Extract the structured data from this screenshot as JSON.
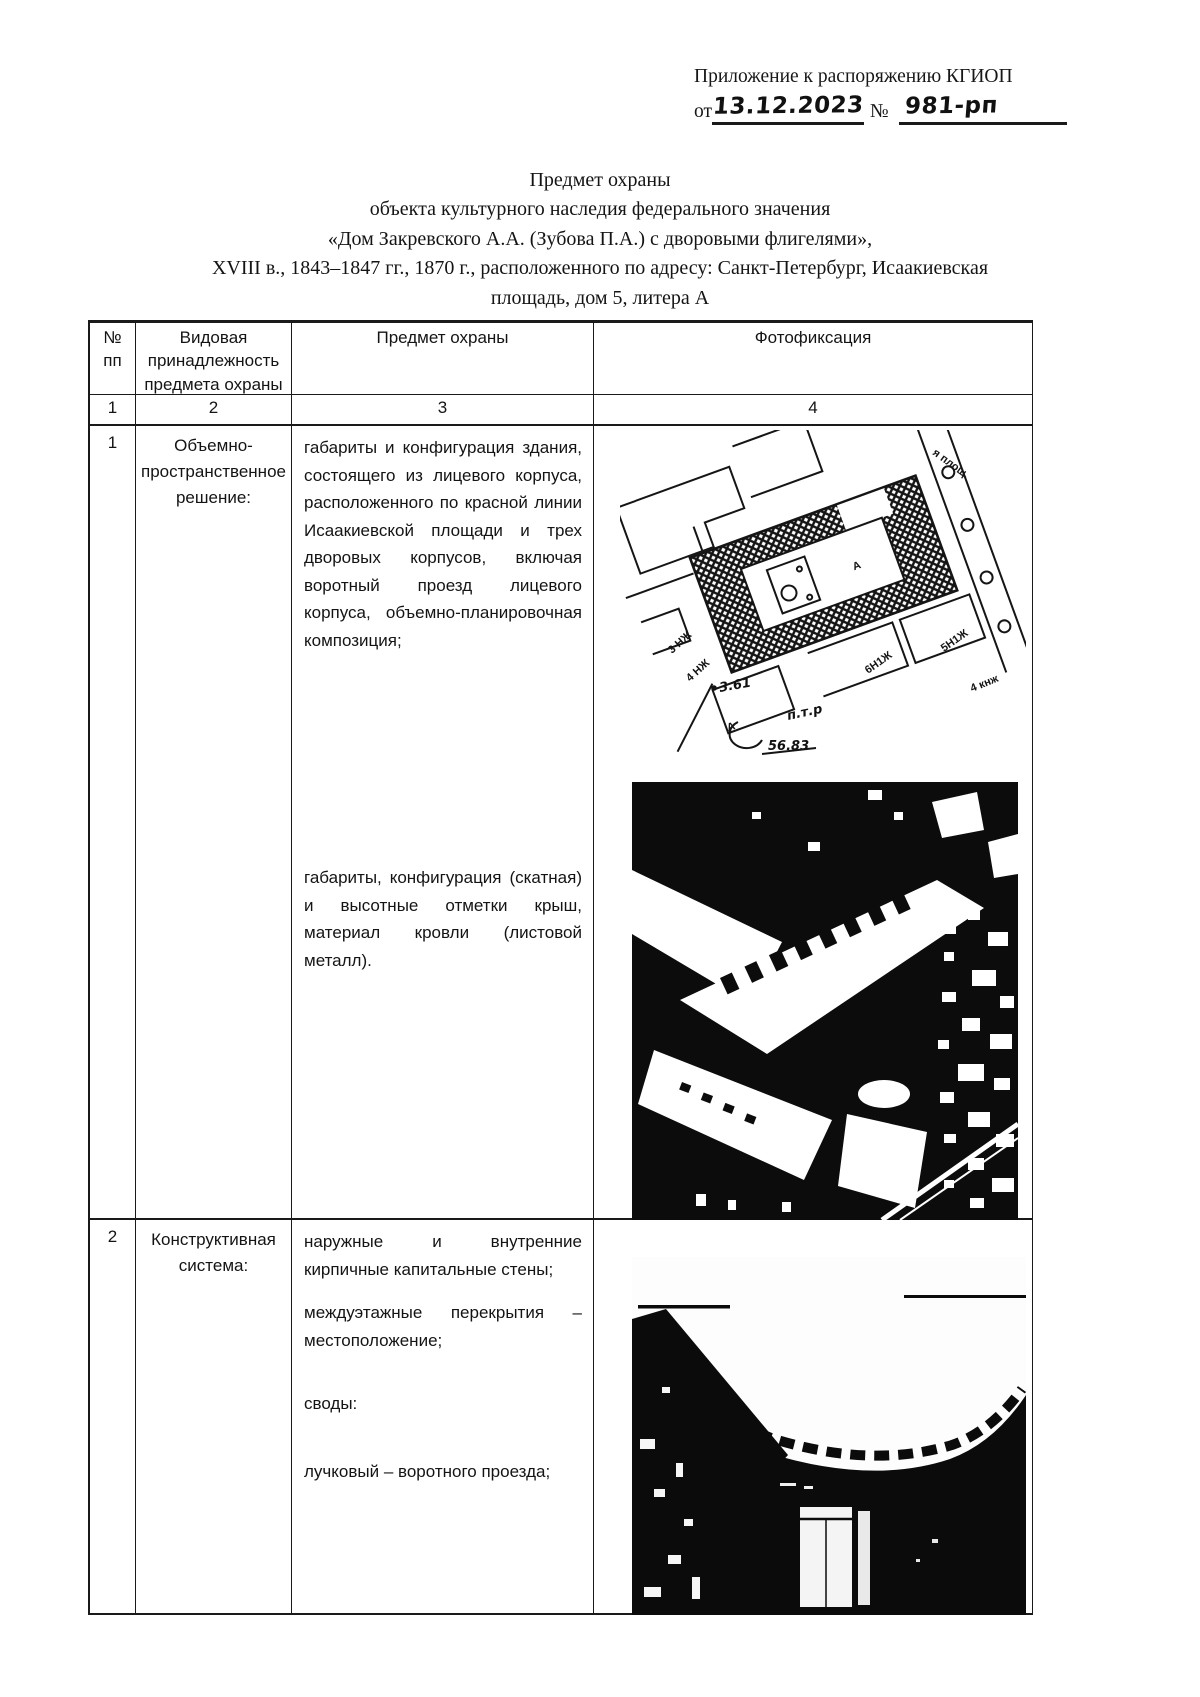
{
  "colors": {
    "ink": "#151515",
    "paper": "#ffffff"
  },
  "header": {
    "line1": "Приложение к распоряжению КГИОП",
    "from_label": "от",
    "date": "13.12.2023",
    "no_label": "№",
    "number": "981-рп"
  },
  "title": {
    "lines": [
      "Предмет охраны",
      "объекта культурного наследия федерального значения",
      "«Дом Закревского А.А. (Зубова П.А.) с дворовыми флигелями»,",
      "XVIII в., 1843–1847 гг., 1870 г., расположенного по адресу: Санкт-Петербург, Исаакиевская",
      "площадь, дом 5, литера А"
    ]
  },
  "table": {
    "headers": {
      "col1_line1": "№",
      "col1_line2": "пп",
      "col2": "Видовая принадлежность предмета охраны",
      "col3": "Предмет охраны",
      "col4": "Фотофиксация"
    },
    "column_numbers": [
      "1",
      "2",
      "3",
      "4"
    ],
    "rows": [
      {
        "num": "1",
        "category": "Объемно-пространственное решение:",
        "items": [
          "габариты и конфигурация здания, состоящего из лицевого корпуса, расположенного по красной линии Исаакиевской площади и трех дворовых корпусов, включая воротный проезд лицевого корпуса, объемно-планировочная композиция;",
          "габариты, конфигурация (скатная) и высотные отметки крыш, материал кровли (листовой металл)."
        ]
      },
      {
        "num": "2",
        "category": "Конструктивная система:",
        "items": [
          "наружные и внутренние кирпичные капитальные стены;",
          "междуэтажные перекрытия – местоположение;",
          "своды:",
          "лучковый – воротного проезда;"
        ]
      }
    ]
  },
  "map_labels": {
    "street": "я площ.",
    "b3nj": "3 НЖ",
    "b4nj": "4 НЖ",
    "b6n1j": "6Н1Ж",
    "b5n1j": "5Н1Ж",
    "b4knj": "4 кнж",
    "litera_a_court": "А",
    "litera_a_small": "А",
    "elev1": "3.61",
    "hand_ptr": "п.т.р",
    "hand_5683": "56.83"
  }
}
